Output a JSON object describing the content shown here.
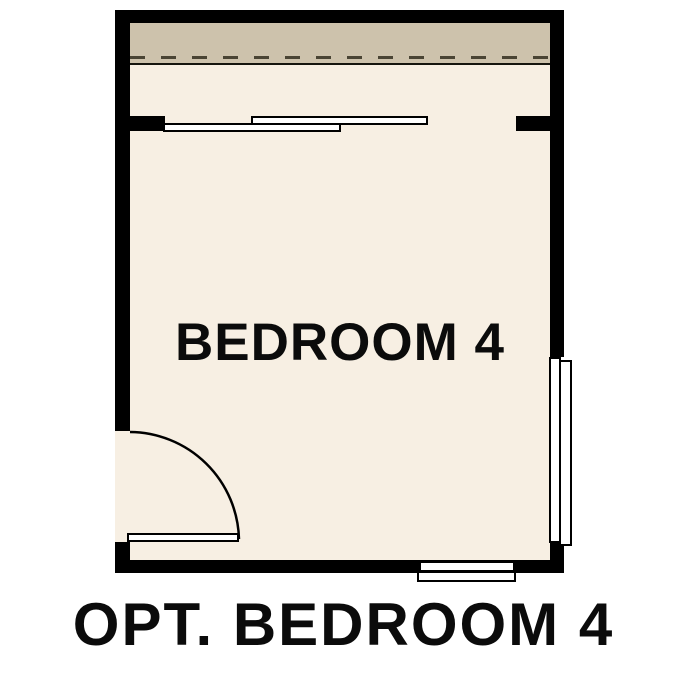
{
  "plan": {
    "room_label": "BEDROOM 4"
  },
  "caption": "OPT. BEDROOM 4",
  "colors": {
    "wall": "#000000",
    "interior": "#f7efe3",
    "band": "#cdc2ac",
    "dash": "#4a4434",
    "fixture": "#ffffff",
    "label": "#0b0b0b",
    "background": "#ffffff"
  }
}
